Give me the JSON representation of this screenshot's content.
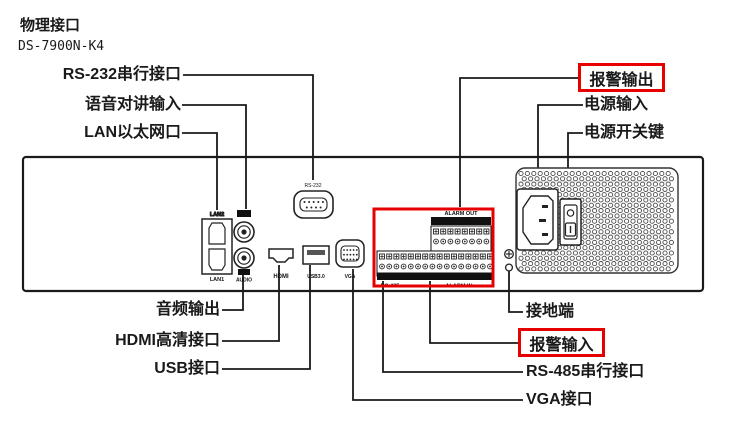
{
  "header": {
    "title": "物理接口",
    "model": "DS-7900N-K4"
  },
  "colors": {
    "highlight": "#e60000",
    "line": "#1a1a1a"
  },
  "callouts": {
    "rs232": "RS-232串行接口",
    "audio_talk_in": "语音对讲输入",
    "lan": "LAN以太网口",
    "alarm_out": "报警输出",
    "power_in": "电源输入",
    "power_switch": "电源开关键",
    "audio_out": "音频输出",
    "hdmi": "HDMI高清接口",
    "usb": "USB接口",
    "ground": "接地端",
    "alarm_in": "报警输入",
    "rs485": "RS-485串行接口",
    "vga": "VGA接口"
  },
  "device": {
    "lan2": "LAN2",
    "lan1": "LAN1",
    "audio_in_badge": "IN",
    "audio_out_badge": "OUT",
    "audio_jack": "AUDIO",
    "rs232_port": "RS-232",
    "hdmi_port": "HDMI",
    "usb_port": "USB3.0",
    "vga_port": "VGA",
    "alarm_out_port": "ALARM OUT",
    "alarm_out_pins": "1 G 2 G 3 G 4 G",
    "alarm_in_pins": "D+ D- G 1 2 3 4 5 6 7 8 G 9 10 11 12 13 14 15 16",
    "rs485_port": "RS-485",
    "alarm_in_port": "ALARM IN"
  }
}
